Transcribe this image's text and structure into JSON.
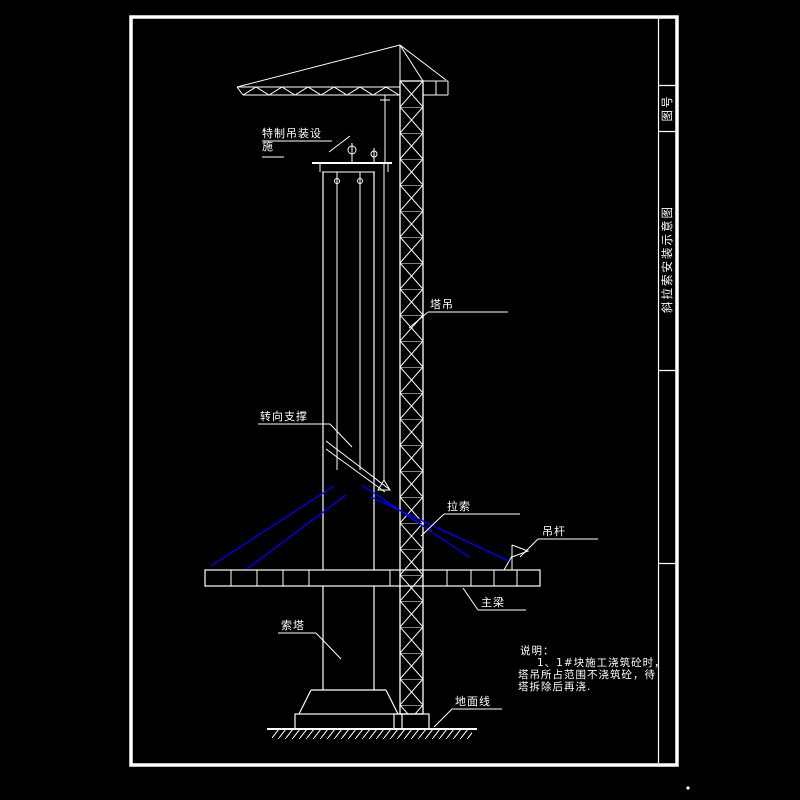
{
  "colors": {
    "background": "#000000",
    "line": "#ffffff",
    "cable": "#0000fe"
  },
  "title_block": {
    "drawing_no_label": "图号",
    "drawing_title": "斜拉索安装示意图"
  },
  "labels": {
    "lifting_device": "特制吊装设施",
    "tower_crane": "塔吊",
    "turning_support": "转向支撑",
    "stay_cable": "拉索",
    "hanger_rod": "吊杆",
    "main_girder": "主梁",
    "pylon": "索塔",
    "ground_line": "地面线"
  },
  "notes": {
    "heading": "说明：",
    "line1": "1、1#块施工浇筑砼时，",
    "line2": "塔吊所占范围不浇筑砼，待",
    "line3": "塔拆除后再浇."
  }
}
